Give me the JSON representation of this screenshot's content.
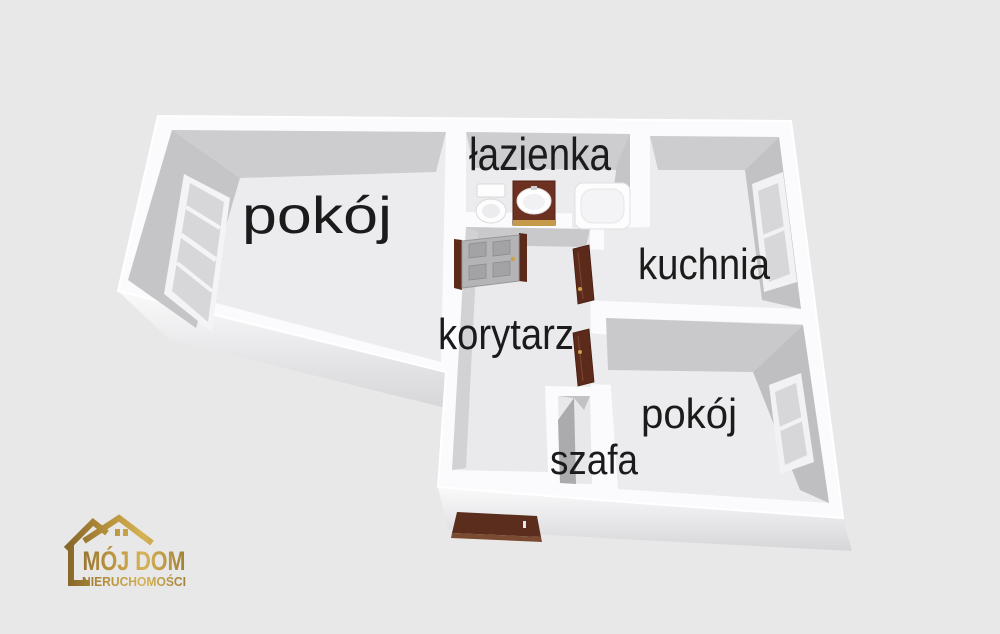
{
  "palette": {
    "background": "#e8e8e9",
    "wall_white": "#fbfbfd",
    "floor": "#ececee",
    "wall_face": "#c6c6c9",
    "wall_face_dark": "#ababae",
    "window_pane": "#d7d7da",
    "door_brown": "#5c2a1b",
    "entrance_door_brown": "#5a2d1d",
    "cabinet_brown": "#6d3122",
    "handle_gold": "#c9a14c",
    "logo_gold": "#b8923c",
    "label_text": "#1b1b1b"
  },
  "floor_plan": {
    "rooms": [
      {
        "id": "pokoj-1",
        "label": "pokój"
      },
      {
        "id": "lazienka",
        "label": "łazienka"
      },
      {
        "id": "kuchnia",
        "label": "kuchnia"
      },
      {
        "id": "korytarz",
        "label": "korytarz"
      },
      {
        "id": "pokoj-2",
        "label": "pokój"
      },
      {
        "id": "szafa",
        "label": "szafa"
      }
    ],
    "fixtures": [
      {
        "name": "toilet"
      },
      {
        "name": "washbasin-cabinet"
      },
      {
        "name": "bathtub"
      }
    ],
    "doors": [
      {
        "name": "paneled-interior-door"
      },
      {
        "name": "kuchnia-door-leaf"
      },
      {
        "name": "pokoj-door-leaf"
      },
      {
        "name": "entrance-door"
      }
    ],
    "windows": [
      {
        "name": "pokoj-1-window"
      },
      {
        "name": "kuchnia-window"
      },
      {
        "name": "pokoj-2-window"
      }
    ]
  },
  "logo": {
    "line1": "MÓJ DOM",
    "line2": "NIERUCHOMOŚCI"
  }
}
